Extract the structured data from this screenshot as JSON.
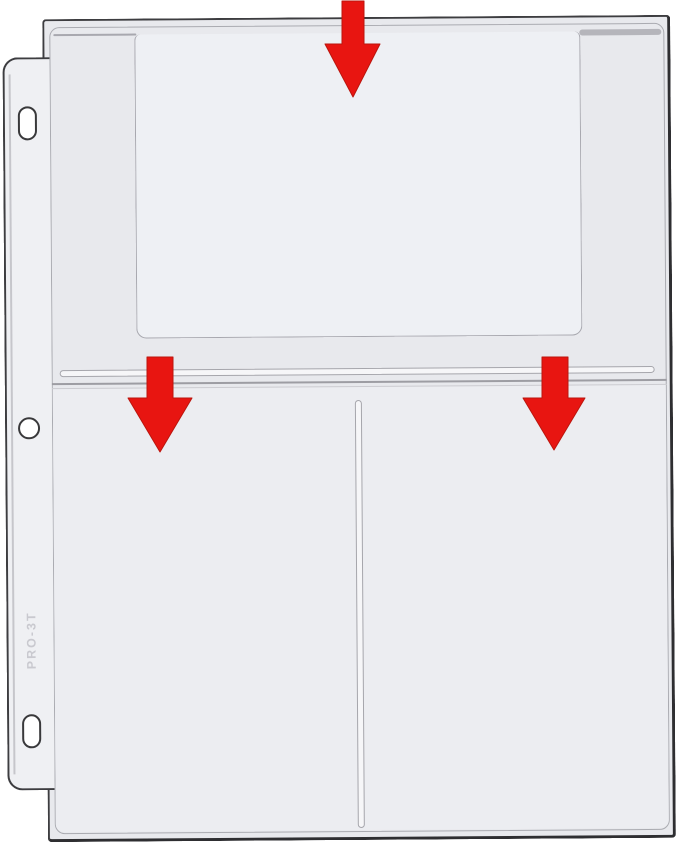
{
  "product": {
    "embossed_text": "PRO-3T",
    "description_visible": "clear 3-pocket binder page with punch holes"
  },
  "pockets": {
    "count": 3,
    "openings_marked_by_arrows": 3,
    "arrow_direction": "down"
  },
  "colors": {
    "arrow_red": "#E81511",
    "page_outline": "#3D3D40",
    "page_fill": "#E8E9ED",
    "seam_gray": "#A8A8AF",
    "emboss_gray": "#C9C9CF",
    "background": "#FFFFFF"
  },
  "icons": {
    "arrow": "down-arrow-icon"
  }
}
